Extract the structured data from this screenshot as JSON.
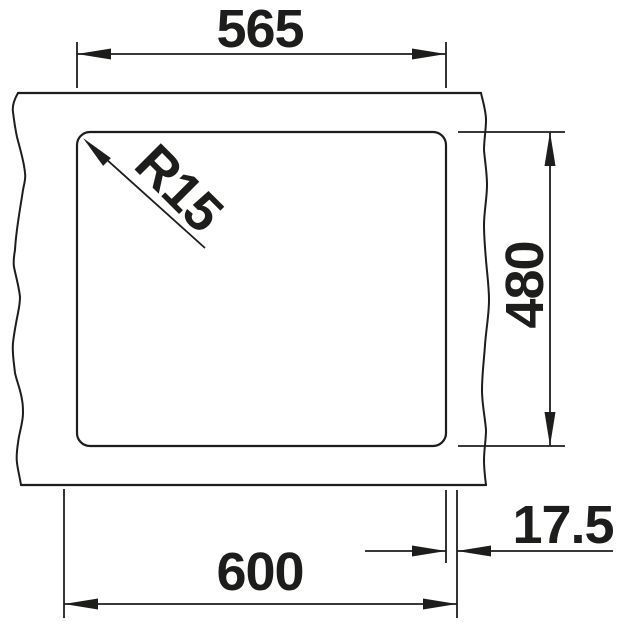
{
  "drawing": {
    "line_color": "#1d1d1b",
    "background_color": "#ffffff",
    "labels": {
      "cutout_width": "565",
      "cutout_depth": "480",
      "cabinet_width": "600",
      "edge_offset": "17.5",
      "corner_radius": "R15"
    }
  }
}
